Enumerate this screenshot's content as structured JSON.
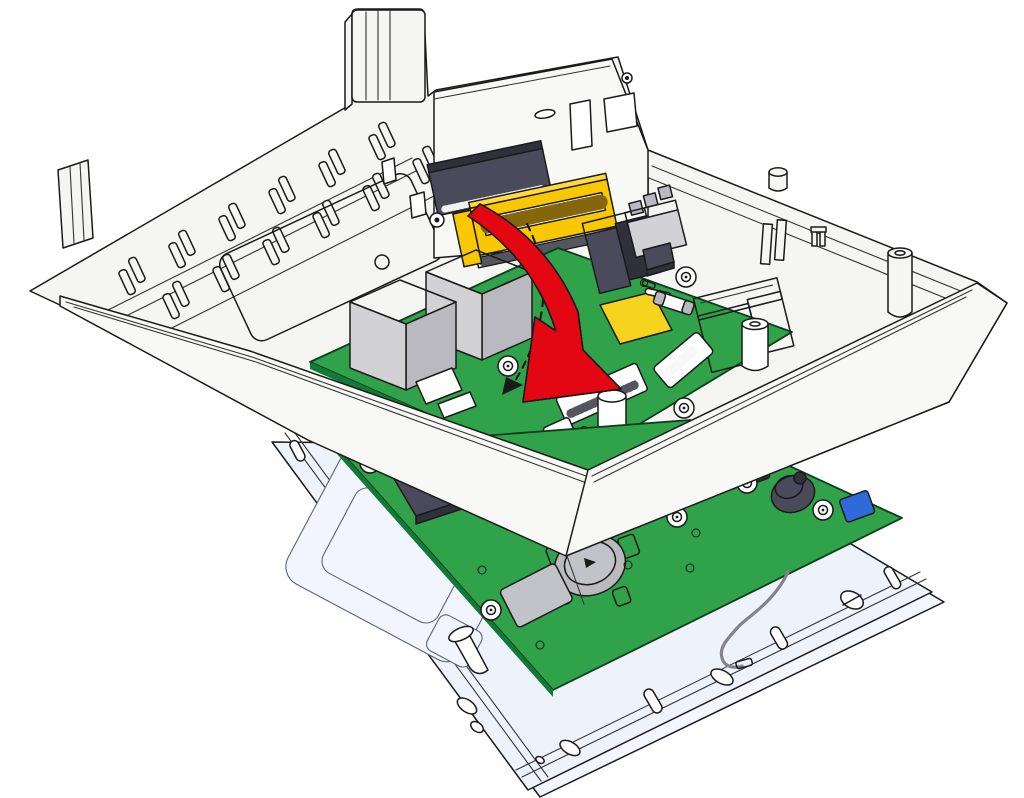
{
  "illustration": {
    "kind": "device-assembly-step-diagram",
    "action_shown": "fold-io-board-down-into-rear-housing",
    "visible_text": "",
    "parts": [
      {
        "name": "rear-housing",
        "desc": "white plastic back enclosure with DIN-rail clips and mounting tabs"
      },
      {
        "name": "connector-panel",
        "desc": "inner vertical panel with rectangular cutouts"
      },
      {
        "name": "bus-connector-dark",
        "desc": "dark board-to-board connector on panel"
      },
      {
        "name": "bus-connector-yellow",
        "desc": "yellow card-edge connector with pin comb"
      },
      {
        "name": "io-board",
        "desc": "upper green PCB tilted during insertion"
      },
      {
        "name": "ethernet-jack-left",
        "desc": "gray modular jack"
      },
      {
        "name": "ethernet-jack-right",
        "desc": "gray modular jack"
      },
      {
        "name": "usb-connector",
        "desc": "dark connector block"
      },
      {
        "name": "terminal-block",
        "desc": "3-pole gray terminal"
      },
      {
        "name": "relay",
        "desc": "large white relay box"
      },
      {
        "name": "fuse",
        "desc": "white cylindrical fuse"
      },
      {
        "name": "dip-switch",
        "desc": "white switch block"
      },
      {
        "name": "yellow-pad",
        "desc": "yellow square component"
      },
      {
        "name": "rotation-arrow",
        "desc": "thick red arrow showing fold-down direction"
      },
      {
        "name": "rotation-path",
        "desc": "black dashed arc with small arrowhead"
      },
      {
        "name": "main-board",
        "desc": "lower green PCB mounted on front frame"
      },
      {
        "name": "coin-cell-holder",
        "desc": "metal coin cell battery clip"
      },
      {
        "name": "microsd-slot",
        "desc": "metal micro SD card slot"
      },
      {
        "name": "buzzer",
        "desc": "dark round buzzer"
      },
      {
        "name": "trimmer-blue",
        "desc": "small blue component"
      },
      {
        "name": "antenna-cable",
        "desc": "gray antenna wire over frame edge"
      },
      {
        "name": "front-frame",
        "desc": "pale front tray with oval holes, pins and slotted screw"
      }
    ]
  },
  "colors": {
    "outline": "#1a1a1a",
    "case_white": "#f5f5f3",
    "panel_white": "#f8f8f7",
    "pcb_green": "#2fa24a",
    "pcb_edge": "#117a36",
    "pcb_dark": "#0d3d1d",
    "arrow_red": "#e30613",
    "yellow_connector": "#f9c800",
    "yellow_light": "#ffda3d",
    "yellow_pad": "#f6d41e",
    "slate_dark": "#4a4a5a",
    "slate_deep": "#30303c",
    "gray_light": "#d2d2d6",
    "gray_mid": "#b9b9bf",
    "metal_gray": "#c2c2c9",
    "tray_white": "#eef2fb",
    "tray_base": "#f3f6fe",
    "tray_inner": "#f2f5fd",
    "wire_gray": "#83838a",
    "blue_comp": "#2f6bd8"
  }
}
